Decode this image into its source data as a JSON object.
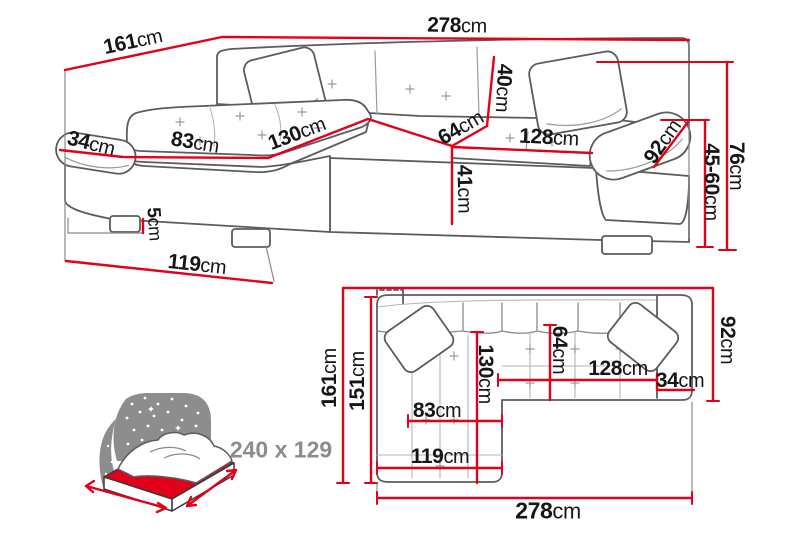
{
  "perspective_view": {
    "d161": {
      "value": "161",
      "unit": "cm"
    },
    "d278": {
      "value": "278",
      "unit": "cm"
    },
    "d40": {
      "value": "40",
      "unit": "cm"
    },
    "d64": {
      "value": "64",
      "unit": "cm"
    },
    "d128": {
      "value": "128",
      "unit": "cm"
    },
    "d92": {
      "value": "92",
      "unit": "cm"
    },
    "d41": {
      "value": "41",
      "unit": "cm"
    },
    "d76": {
      "value": "76",
      "unit": "cm"
    },
    "d45_60": {
      "value": "45-60",
      "unit": "cm"
    },
    "d34": {
      "value": "34",
      "unit": "cm"
    },
    "d83": {
      "value": "83",
      "unit": "cm"
    },
    "d130": {
      "value": "130",
      "unit": "cm"
    },
    "d5": {
      "value": "5",
      "unit": "cm"
    },
    "d119": {
      "value": "119",
      "unit": "cm"
    }
  },
  "top_view": {
    "d161": {
      "value": "161",
      "unit": "cm"
    },
    "d151": {
      "value": "151",
      "unit": "cm"
    },
    "d92": {
      "value": "92",
      "unit": "cm"
    },
    "d64": {
      "value": "64",
      "unit": "cm"
    },
    "d130": {
      "value": "130",
      "unit": "cm"
    },
    "d83": {
      "value": "83",
      "unit": "cm"
    },
    "d119": {
      "value": "119",
      "unit": "cm"
    },
    "d128": {
      "value": "128",
      "unit": "cm"
    },
    "d34": {
      "value": "34",
      "unit": "cm"
    },
    "d278": {
      "value": "278",
      "unit": "cm"
    }
  },
  "sleeping_area": {
    "label": "240 x 129"
  },
  "colors": {
    "dimension_red": "#e2011a",
    "outline_gray": "#5c5c5c",
    "muted_gray": "#8c8c8c",
    "icon_gray": "#8d8d8d",
    "text": "#161616"
  }
}
